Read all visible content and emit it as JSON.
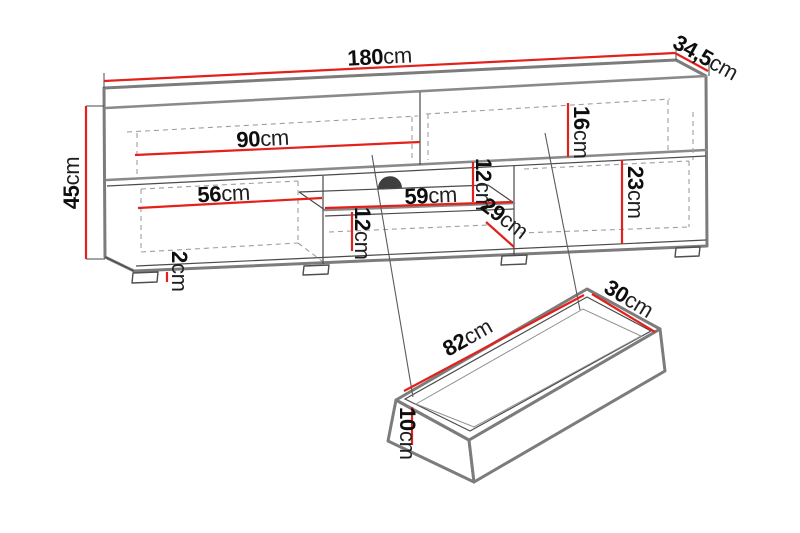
{
  "diagram": {
    "type": "furniture-dimension-drawing",
    "subject": "TV stand with open shelves, drop-down fronts and pull-out drawer",
    "unit": "cm"
  },
  "colors": {
    "dimension_line": "#e2211c",
    "outline_strong": "#7c7c7c",
    "outline_thin": "#4a4a4a",
    "hidden_line": "#9e9e9e",
    "text": "#0e0e0e",
    "cable_hole": "#3f3f3f",
    "background": "#ffffff"
  },
  "dims": {
    "total_width": {
      "value": "180",
      "unit": "cm"
    },
    "total_depth": {
      "value": "34,5",
      "unit": "cm"
    },
    "total_height": {
      "value": "45",
      "unit": "cm"
    },
    "left_flap_width": {
      "value": "90",
      "unit": "cm"
    },
    "left_compartment_width": {
      "value": "56",
      "unit": "cm"
    },
    "niche_width": {
      "value": "59",
      "unit": "cm"
    },
    "niche_upper_height": {
      "value": "12",
      "unit": "cm"
    },
    "niche_lower_height": {
      "value": "12",
      "unit": "cm"
    },
    "right_top_clearance": {
      "value": "16",
      "unit": "cm"
    },
    "right_compartment_height": {
      "value": "23",
      "unit": "cm"
    },
    "niche_depth": {
      "value": "29",
      "unit": "cm"
    },
    "foot_height": {
      "value": "2",
      "unit": "cm"
    },
    "drawer_length": {
      "value": "82",
      "unit": "cm"
    },
    "drawer_depth": {
      "value": "30",
      "unit": "cm"
    },
    "drawer_height": {
      "value": "10",
      "unit": "cm"
    }
  }
}
